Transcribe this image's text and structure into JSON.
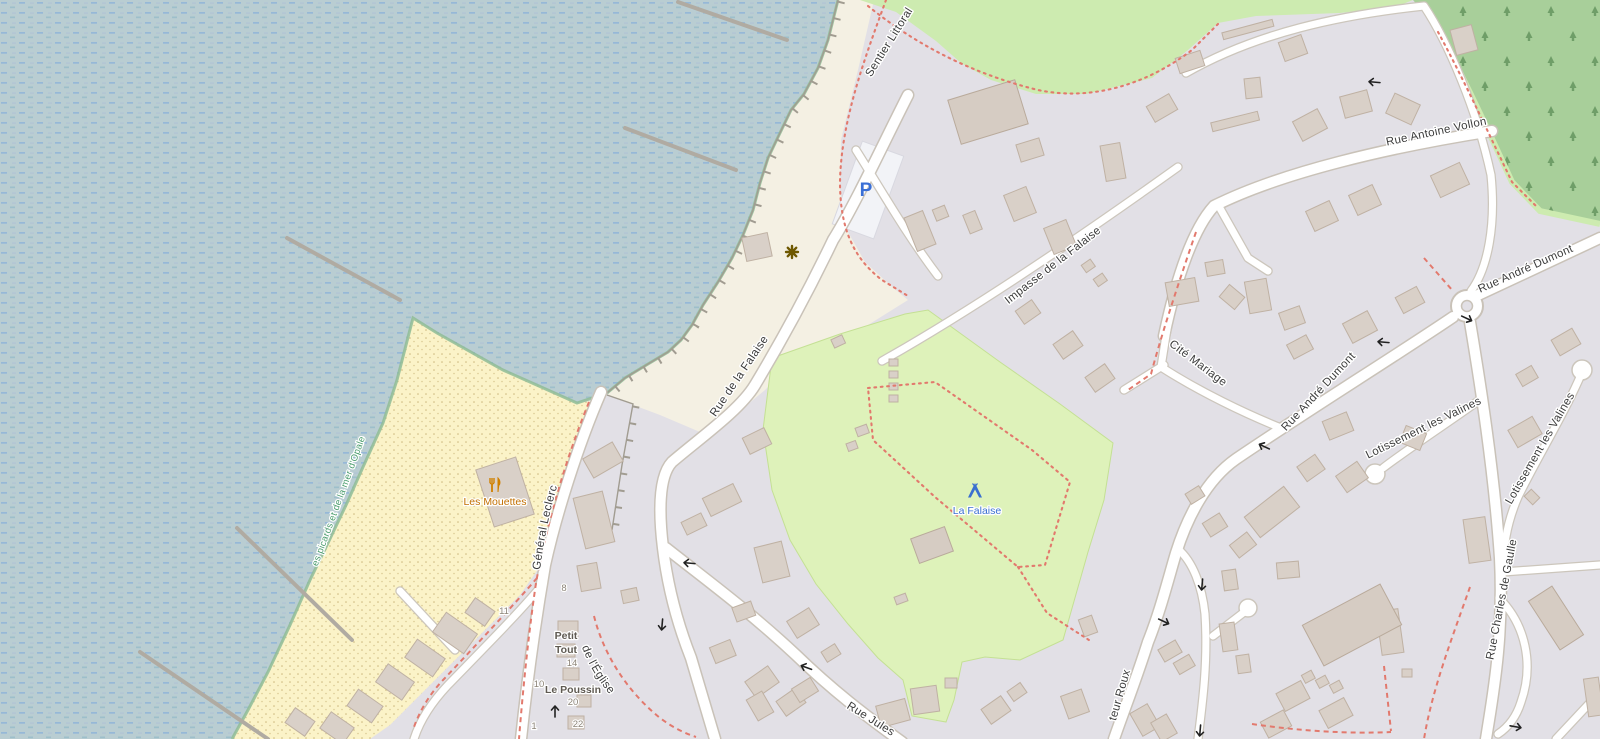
{
  "map": {
    "type": "openstreetmap-tile-view",
    "labels": {
      "streets": {
        "sentier_littoral": "Sentier Littoral",
        "rue_antoine_vollon": "Rue Antoine Vollon",
        "impasse_de_la_falaise": "Impasse de la Falaise",
        "rue_andre_dumont": "Rue André Dumont",
        "cite_mariage": "Cité Mariage",
        "rue_de_la_falaise": "Rue de la Falaise",
        "esplanade_du_general_leclerc": "Esplanade du Général Leclerc",
        "lotissement_les_valines": "Lotissement les Valines",
        "rue_charles_de_gaulle": "Rue Charles de Gaulle",
        "chemin_de_leglise": "Chemin de l'Église",
        "rue_jules": "Rue Jules",
        "docteur_roux_partial": "teur Roux"
      },
      "places": {
        "les_mouettes": "Les Mouettes",
        "la_falaise": "La Falaise",
        "petit_tout_line1": "Petit",
        "petit_tout_line2": "Tout",
        "le_poussin": "Le Poussin",
        "parc_naturel": "Parc naturel marin des Estuaires picards et de la mer d'Opale"
      },
      "house_numbers": {
        "n8": "8",
        "n11": "11",
        "n10": "10",
        "n14": "14",
        "n20": "20",
        "n22": "22",
        "n1": "1"
      },
      "icons": {
        "parking_letter": "P"
      }
    },
    "icons": [
      "parking-icon",
      "restaurant-icon",
      "campsite-icon",
      "attraction-icon",
      "oneway-arrow-icon"
    ],
    "colors": {
      "water": "#b9cdd2",
      "water_dash": "#8ab1d8",
      "beach": "#fbf3c8",
      "grass": "#cdebb0",
      "campsite_green": "#def2ba",
      "forest": "#a8cf9a",
      "residential": "#e2e0e6",
      "building": "#d9d0c8",
      "road": "#ffffff",
      "footpath_red": "#e2796d",
      "street_label": "#3c3c3c",
      "poi_orange": "#c26f00",
      "poi_blue": "#3a6fd0",
      "protected_area_green": "#4a9c6d",
      "parking_blue": "#3a6fd6"
    }
  }
}
